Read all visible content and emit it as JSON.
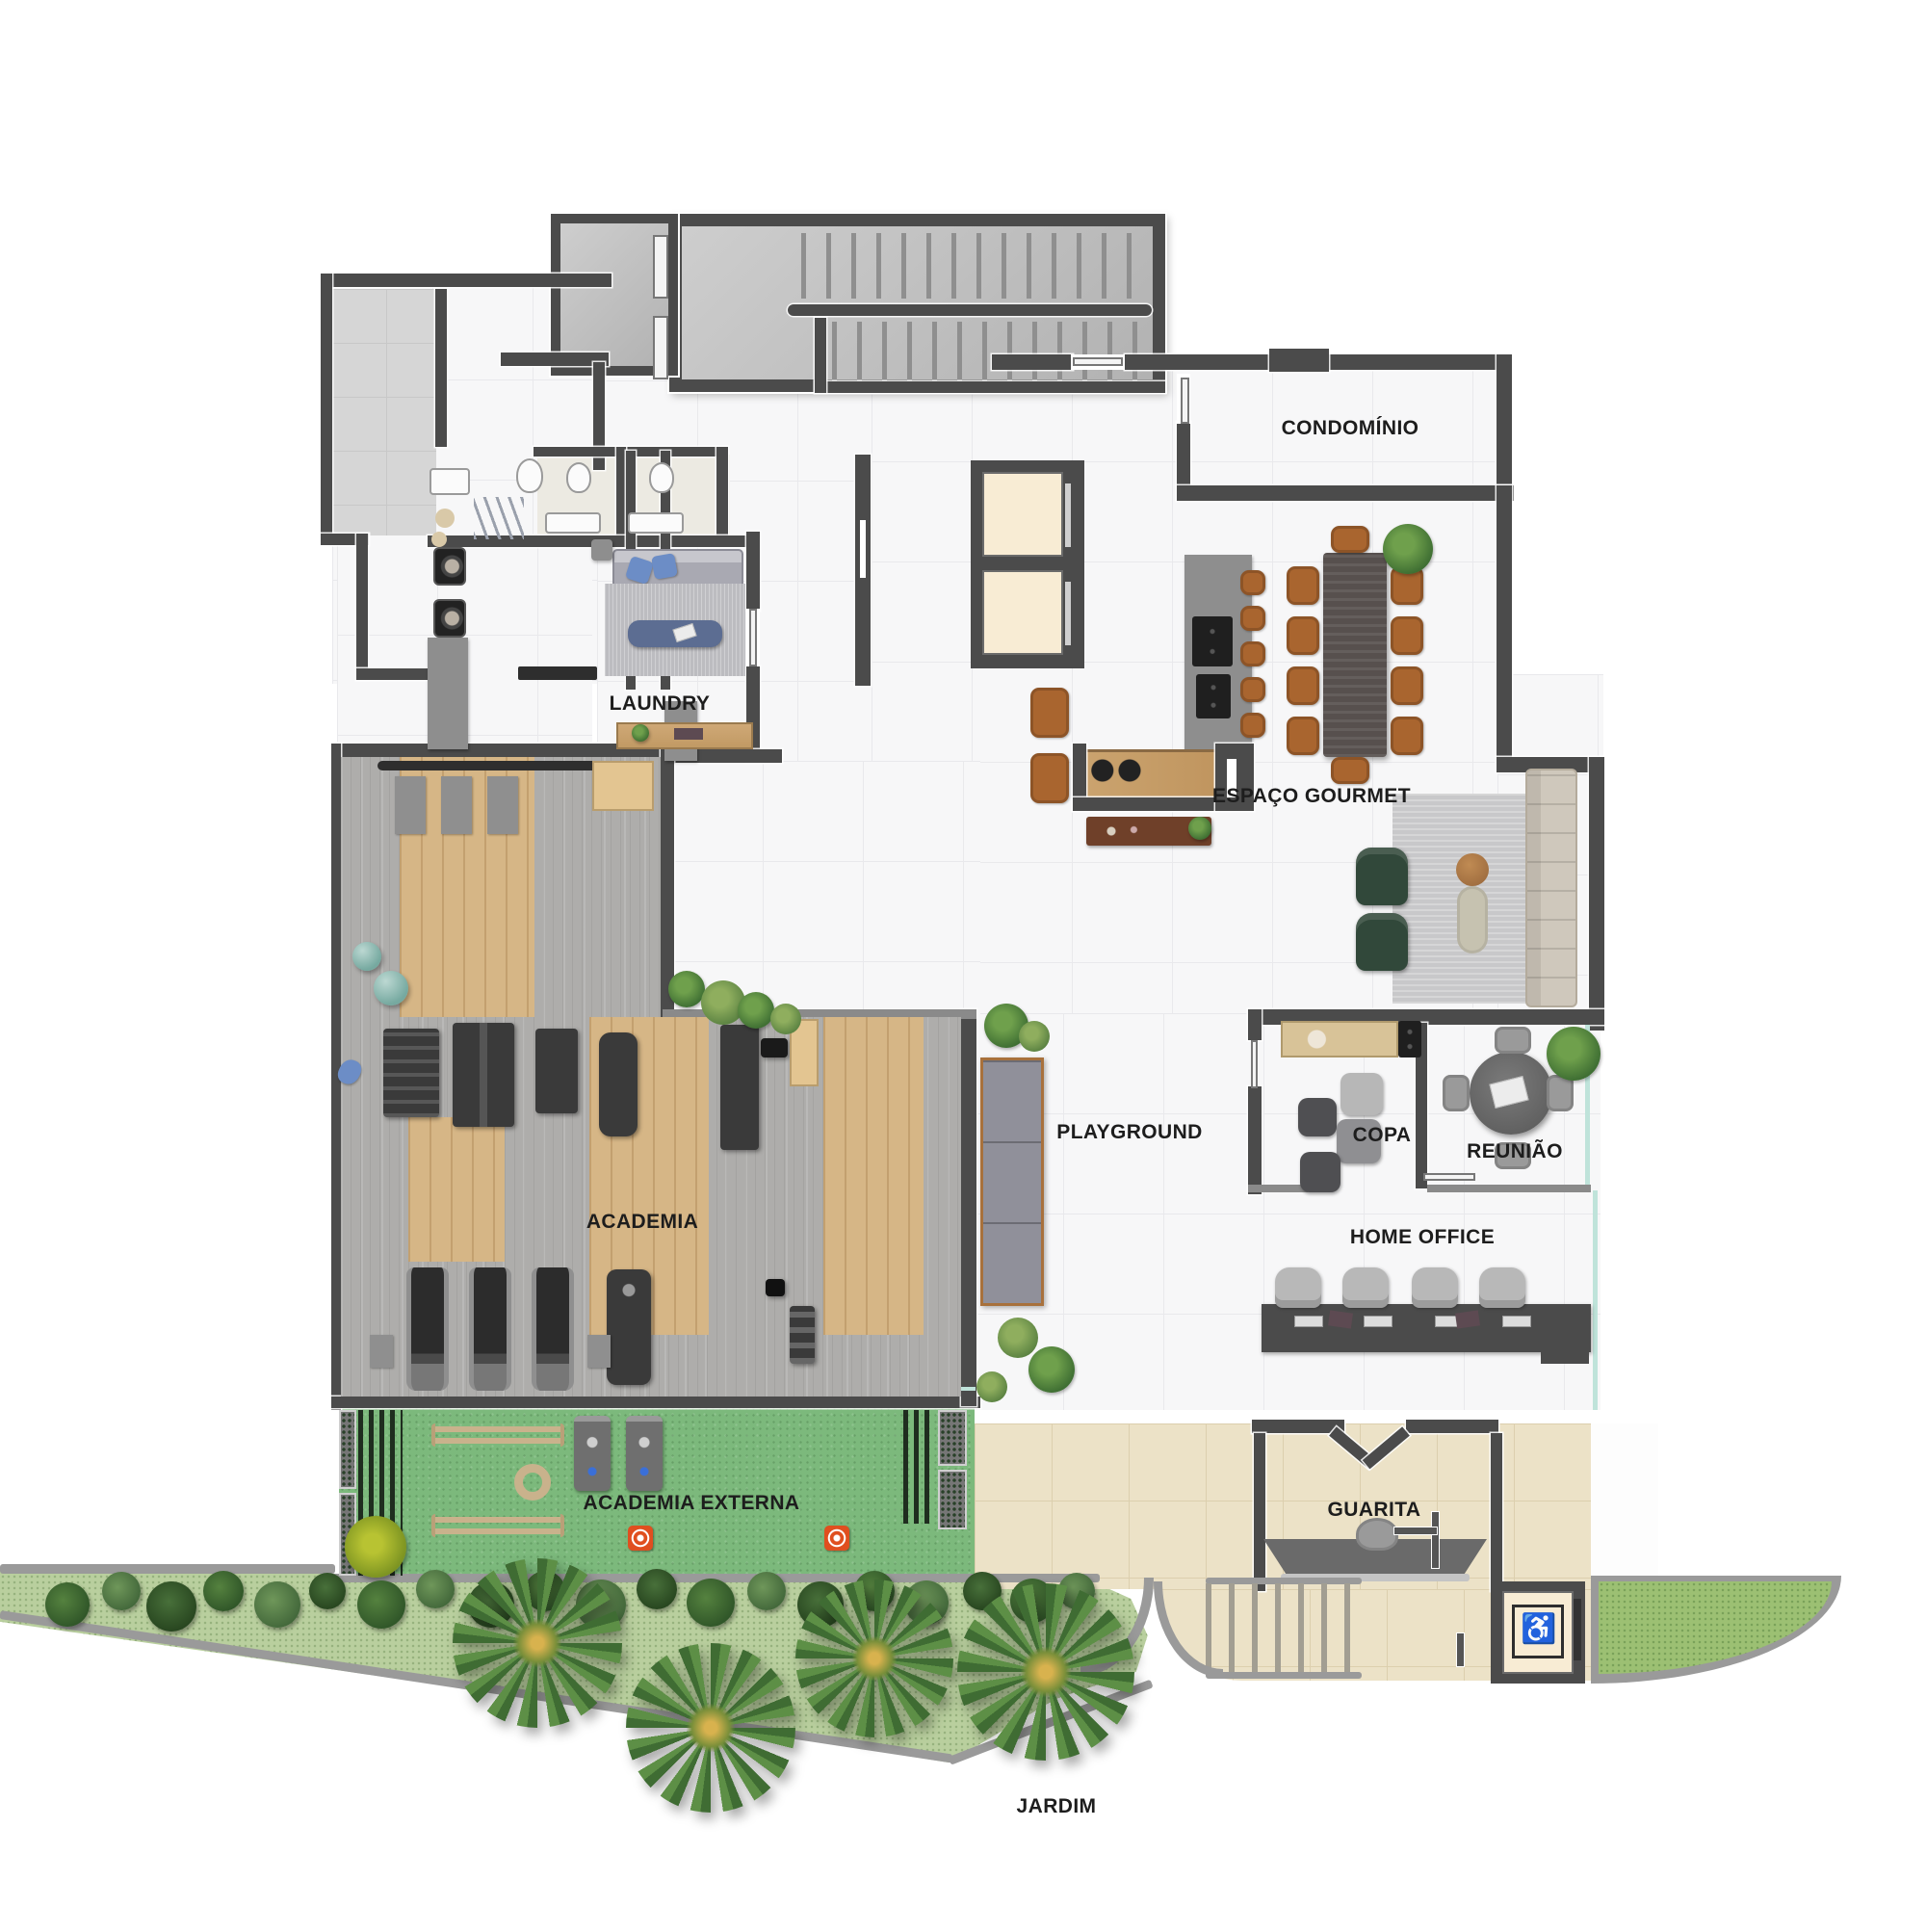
{
  "labels": {
    "condominio": "CONDOMÍNIO",
    "laundry": "LAUNDRY",
    "espaco_gourmet": "ESPAÇO GOURMET",
    "academia": "ACADEMIA",
    "playground": "PLAYGROUND",
    "copa": "COPA",
    "reuniao": "REUNIÃO",
    "home_office": "HOME OFFICE",
    "academia_externa": "ACADEMIA EXTERNA",
    "guarita": "GUARITA",
    "jardim": "JARDIM"
  },
  "icons": {
    "accessible_elevator": "♿"
  },
  "colors": {
    "wall": "#4b4b4b",
    "tile": "#f7f7f8",
    "tile_line": "#e9e9ec",
    "concrete": "#bdbdbd",
    "grass": "#7cb97c",
    "garden": "#b9cf9e",
    "lawn": "#9cc073",
    "paving": "#ece2c7",
    "glass": "#bfe3da",
    "chair_brown": "#a9652f",
    "table_dark": "#57504e",
    "armchair": "#31483a",
    "pillow": "#6c8dc6",
    "accent_red": "#e04f1f",
    "curb": "#9a9a9a"
  }
}
